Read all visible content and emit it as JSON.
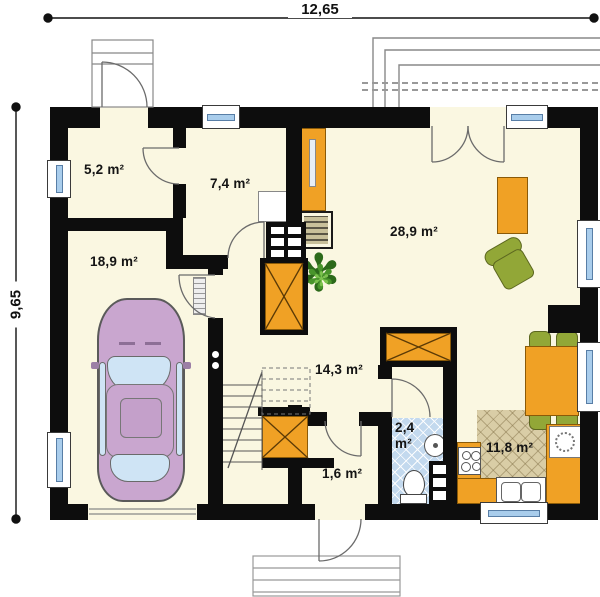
{
  "plan": {
    "title": "house ground floor plan",
    "dimension_width": "12,65",
    "dimension_height": "9,65",
    "rooms": [
      {
        "key": "storage",
        "area": "5,2 m²"
      },
      {
        "key": "entry-hall",
        "area": "7,4 m²"
      },
      {
        "key": "garage",
        "area": "18,9 m²"
      },
      {
        "key": "living-room",
        "area": "28,9 m²"
      },
      {
        "key": "stair-hall",
        "area": "14,3 m²"
      },
      {
        "key": "bathroom",
        "area": "2,4 m²"
      },
      {
        "key": "vestibule",
        "area": "1,6 m²"
      },
      {
        "key": "kitchen",
        "area": "11,8 m²"
      }
    ],
    "furniture": [
      "car",
      "corner-sofa",
      "armchair",
      "coffee-table",
      "dining-table",
      "dining-chair",
      "kitchen-counter",
      "stove",
      "kitchen-sink",
      "washbasin",
      "toilet",
      "staircase",
      "fireplace",
      "tall-cabinet",
      "closet",
      "plant",
      "radiator"
    ],
    "colors": {
      "wall": "#0d0d0d",
      "floor": "#faf7e1",
      "accent_orange": "#f0a125",
      "sofa_green": "#92a737",
      "bath_tile": "#c3d9ee",
      "kitchen_tile": "#d9cda6",
      "car_pink": "#c9a6cf",
      "window_glass": "#a9cdec"
    }
  },
  "icons": {
    "plant_glyph": "✻"
  }
}
